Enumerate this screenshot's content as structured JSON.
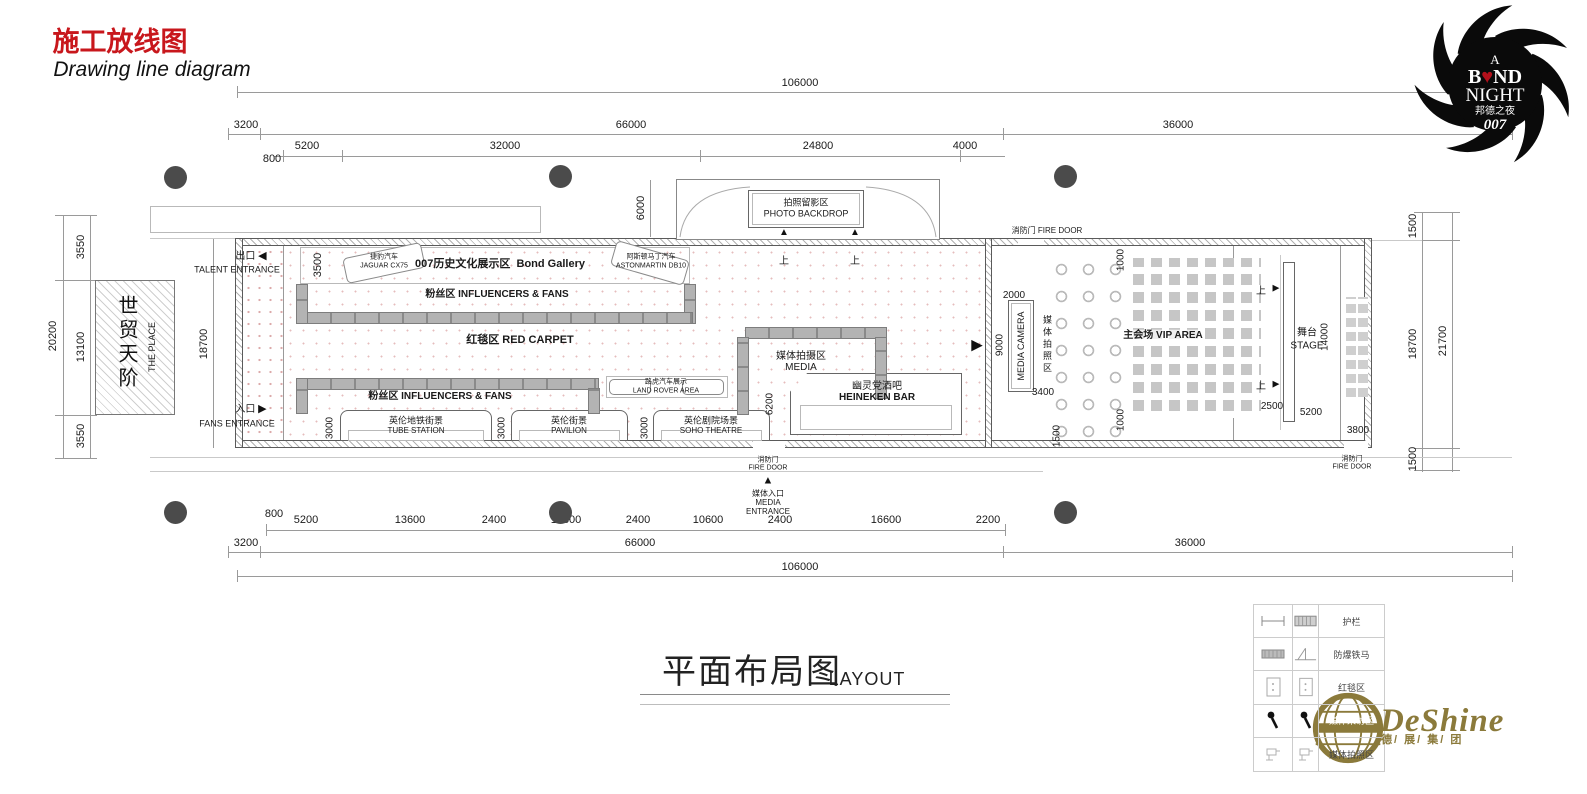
{
  "colors": {
    "title_red": "#c8171c",
    "gold": "#8b7a3b",
    "barrier_gray": "#a8a8a8",
    "column_gray": "#4b4b4b"
  },
  "header": {
    "title_cn": "施工放线图",
    "title_en": "Drawing line diagram"
  },
  "bond_logo": {
    "a": "A",
    "b": "B",
    "heart": "♥",
    "nd": "ND",
    "night": "NIGHT",
    "cn": "邦德之夜",
    "num": "007"
  },
  "icons": {
    "left": "◀",
    "right": "▶",
    "up": "▲"
  },
  "dims": {
    "top_total": "106000",
    "top_3200": "3200",
    "top_66000": "66000",
    "top_36000": "36000",
    "top_800": "800",
    "top_5200": "5200",
    "top_32000": "32000",
    "top_24800": "24800",
    "top_4000": "4000",
    "left_20200": "20200",
    "left_3550_top": "3550",
    "left_13100": "13100",
    "left_3550_bot": "3550",
    "left_18700": "18700",
    "right_1500_top": "1500",
    "right_18700": "18700",
    "right_21700": "21700",
    "right_1500_bot": "1500",
    "bot": [
      "800",
      "5200",
      "13600",
      "2400",
      "10600",
      "2400",
      "10600",
      "2400",
      "16600",
      "2200"
    ],
    "bot_3200": "3200",
    "bot_66000": "66000",
    "bot_36000": "36000",
    "bot_total": "106000",
    "i3500": "3500",
    "i6000": "6000",
    "i3000": "3000",
    "i6200": "6200",
    "i2000": "2000",
    "i9000": "9000",
    "i3400": "3400",
    "i1500": "1500",
    "i1000": "1000",
    "i2500": "2500",
    "i5200": "5200",
    "i14000": "14000",
    "i3800": "3800"
  },
  "areas": {
    "gallery": {
      "cn": "007历史文化展示区",
      "en": "Bond Gallery"
    },
    "jaguar": {
      "cn": "捷豹汽车",
      "en": "JAGUAR CX75"
    },
    "aston": {
      "cn": "阿斯顿马丁汽车",
      "en": "ASTONMARTIN DB10"
    },
    "fans": {
      "cn": "粉丝区",
      "en": "INFLUENCERS & FANS"
    },
    "red_carpet": {
      "cn": "红毯区",
      "en": "RED CARPET"
    },
    "tube": {
      "cn": "英伦地铁街景",
      "en": "TUBE STATION"
    },
    "pavilion": {
      "cn": "英伦街景",
      "en": "PAVILION"
    },
    "soho": {
      "cn": "英伦剧院场景",
      "en": "SOHO THEATRE"
    },
    "landrover": {
      "cn": "路虎汽车展示",
      "en": "LAND ROVER AREA"
    },
    "media": {
      "cn": "媒体拍摄区",
      "en": "MEDIA"
    },
    "heineken": {
      "cn": "幽灵党酒吧",
      "en": "HEINEKEN BAR"
    },
    "backdrop": {
      "cn": "拍照留影区",
      "en": "PHOTO BACKDROP"
    },
    "vip": {
      "cn": "主会场",
      "en": "VIP AREA"
    },
    "stage": {
      "cn": "舞台",
      "en": "STAGE"
    },
    "camera": {
      "cn": "媒体拍照区",
      "en": "MEDIA CAMERA"
    },
    "place": {
      "cn": "世贸天阶",
      "en": "THE PLACE"
    }
  },
  "labels": {
    "talent_exit_cn": "出口",
    "talent_exit_en": "TALENT ENTRANCE",
    "fans_entry_cn": "入口",
    "fans_entry_en": "FANS ENTRANCE",
    "media_entry_cn": "媒体入口",
    "media_entry_en1": "MEDIA",
    "media_entry_en2": "ENTRANCE",
    "fire_cn": "消防门",
    "fire_en": "FIRE DOOR",
    "up": "上"
  },
  "footer": {
    "title_cn": "平面布局图",
    "title_en": "LAYOUT"
  },
  "legend": {
    "rows": [
      "护栏",
      "防爆铁马",
      "红毯区",
      "媒体采访区",
      "媒体拍照区"
    ]
  },
  "brand": {
    "name": "DeShine",
    "cn": "德/ 展/ 集/ 团"
  }
}
